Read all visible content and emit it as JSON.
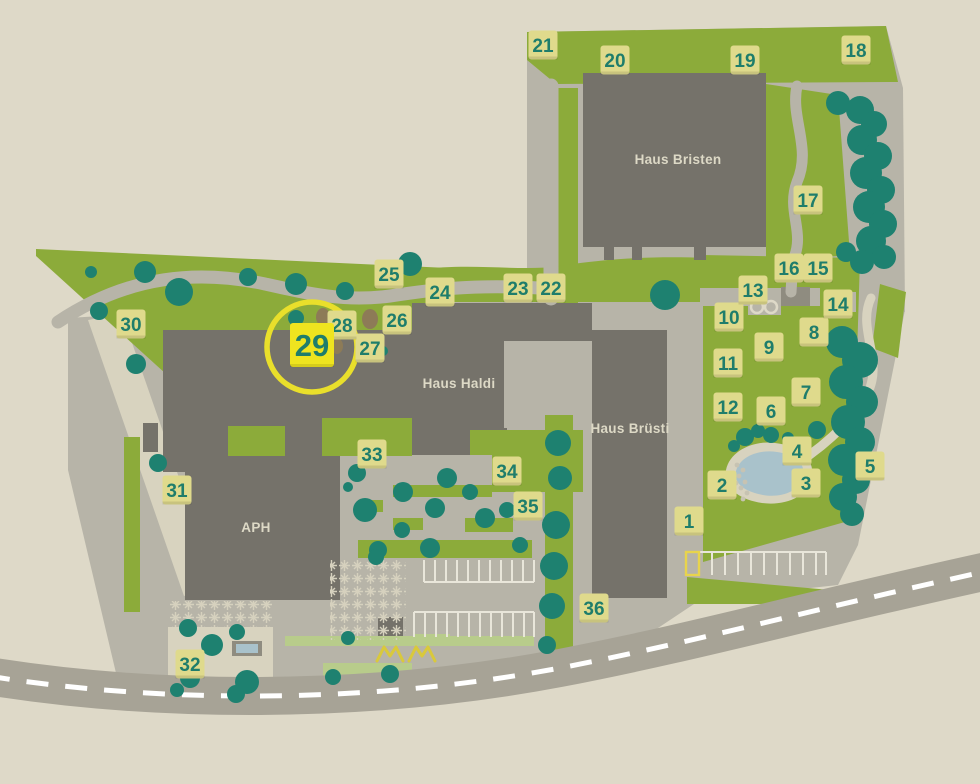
{
  "map": {
    "buildings": [
      {
        "name": "Haus Bristen",
        "x": 678,
        "y": 159
      },
      {
        "name": "Haus Haldi",
        "x": 459,
        "y": 383
      },
      {
        "name": "Haus Brüsti",
        "x": 630,
        "y": 428
      },
      {
        "name": "APH",
        "x": 256,
        "y": 527
      }
    ],
    "markers": [
      {
        "number": "1",
        "x": 689,
        "y": 521,
        "highlighted": false
      },
      {
        "number": "2",
        "x": 722,
        "y": 485,
        "highlighted": false
      },
      {
        "number": "3",
        "x": 806,
        "y": 483,
        "highlighted": false
      },
      {
        "number": "4",
        "x": 797,
        "y": 451,
        "highlighted": false
      },
      {
        "number": "5",
        "x": 870,
        "y": 466,
        "highlighted": false
      },
      {
        "number": "6",
        "x": 771,
        "y": 411,
        "highlighted": false
      },
      {
        "number": "7",
        "x": 806,
        "y": 392,
        "highlighted": false
      },
      {
        "number": "8",
        "x": 814,
        "y": 332,
        "highlighted": false
      },
      {
        "number": "9",
        "x": 769,
        "y": 347,
        "highlighted": false
      },
      {
        "number": "10",
        "x": 729,
        "y": 317,
        "highlighted": false
      },
      {
        "number": "11",
        "x": 728,
        "y": 363,
        "highlighted": false
      },
      {
        "number": "12",
        "x": 728,
        "y": 407,
        "highlighted": false
      },
      {
        "number": "13",
        "x": 753,
        "y": 290,
        "highlighted": false
      },
      {
        "number": "14",
        "x": 838,
        "y": 304,
        "highlighted": false
      },
      {
        "number": "15",
        "x": 818,
        "y": 268,
        "highlighted": false
      },
      {
        "number": "16",
        "x": 789,
        "y": 268,
        "highlighted": false
      },
      {
        "number": "17",
        "x": 808,
        "y": 200,
        "highlighted": false
      },
      {
        "number": "18",
        "x": 856,
        "y": 50,
        "highlighted": false
      },
      {
        "number": "19",
        "x": 745,
        "y": 60,
        "highlighted": false
      },
      {
        "number": "20",
        "x": 615,
        "y": 60,
        "highlighted": false
      },
      {
        "number": "21",
        "x": 543,
        "y": 45,
        "highlighted": false
      },
      {
        "number": "22",
        "x": 551,
        "y": 288,
        "highlighted": false
      },
      {
        "number": "23",
        "x": 518,
        "y": 288,
        "highlighted": false
      },
      {
        "number": "24",
        "x": 440,
        "y": 292,
        "highlighted": false
      },
      {
        "number": "25",
        "x": 389,
        "y": 274,
        "highlighted": false
      },
      {
        "number": "26",
        "x": 397,
        "y": 320,
        "highlighted": false
      },
      {
        "number": "27",
        "x": 370,
        "y": 348,
        "highlighted": false
      },
      {
        "number": "28",
        "x": 342,
        "y": 325,
        "highlighted": false
      },
      {
        "number": "29",
        "x": 312,
        "y": 345,
        "highlighted": true
      },
      {
        "number": "30",
        "x": 131,
        "y": 324,
        "highlighted": false
      },
      {
        "number": "31",
        "x": 177,
        "y": 490,
        "highlighted": false
      },
      {
        "number": "32",
        "x": 190,
        "y": 664,
        "highlighted": false
      },
      {
        "number": "33",
        "x": 372,
        "y": 454,
        "highlighted": false
      },
      {
        "number": "34",
        "x": 507,
        "y": 471,
        "highlighted": false
      },
      {
        "number": "35",
        "x": 528,
        "y": 506,
        "highlighted": false
      },
      {
        "number": "36",
        "x": 594,
        "y": 608,
        "highlighted": false
      }
    ],
    "marker_style": {
      "normal": {
        "size": 29,
        "font": 19
      },
      "highlighted": {
        "size": 44,
        "font": 31
      }
    },
    "highlight": {
      "marker": "29",
      "circle": {
        "cx": 312,
        "cy": 347,
        "r": 45
      }
    },
    "colors": {
      "background": "#DED9C8",
      "pavement": "#B7B4A8",
      "pavement_light": "#D8D3BF",
      "road": "#A7A396",
      "road_dash": "#FFFFFF",
      "grass": "#8CAB3A",
      "grass_light": "#B8CC8B",
      "tree": "#1E8170",
      "building": "#75726A",
      "shed": "#8F8C80",
      "pond": "#A9C2CB",
      "pebble": "#C7C3B2",
      "shrub": "#8D7B57",
      "marker_bg": "#DFDA8C",
      "marker_text": "#1F7D6B",
      "marker_shadow": "rgba(0,0,0,0.10)",
      "highlight_yellow": "#EFE41F",
      "highlight_ring": "#E9DF2B",
      "label_text": "#DDD9C6",
      "parking_line": "#E9E6DA",
      "paver": "#D6D1BE",
      "zigzag": "#D9C93B",
      "stall_highlight": "#E8D44C"
    }
  }
}
